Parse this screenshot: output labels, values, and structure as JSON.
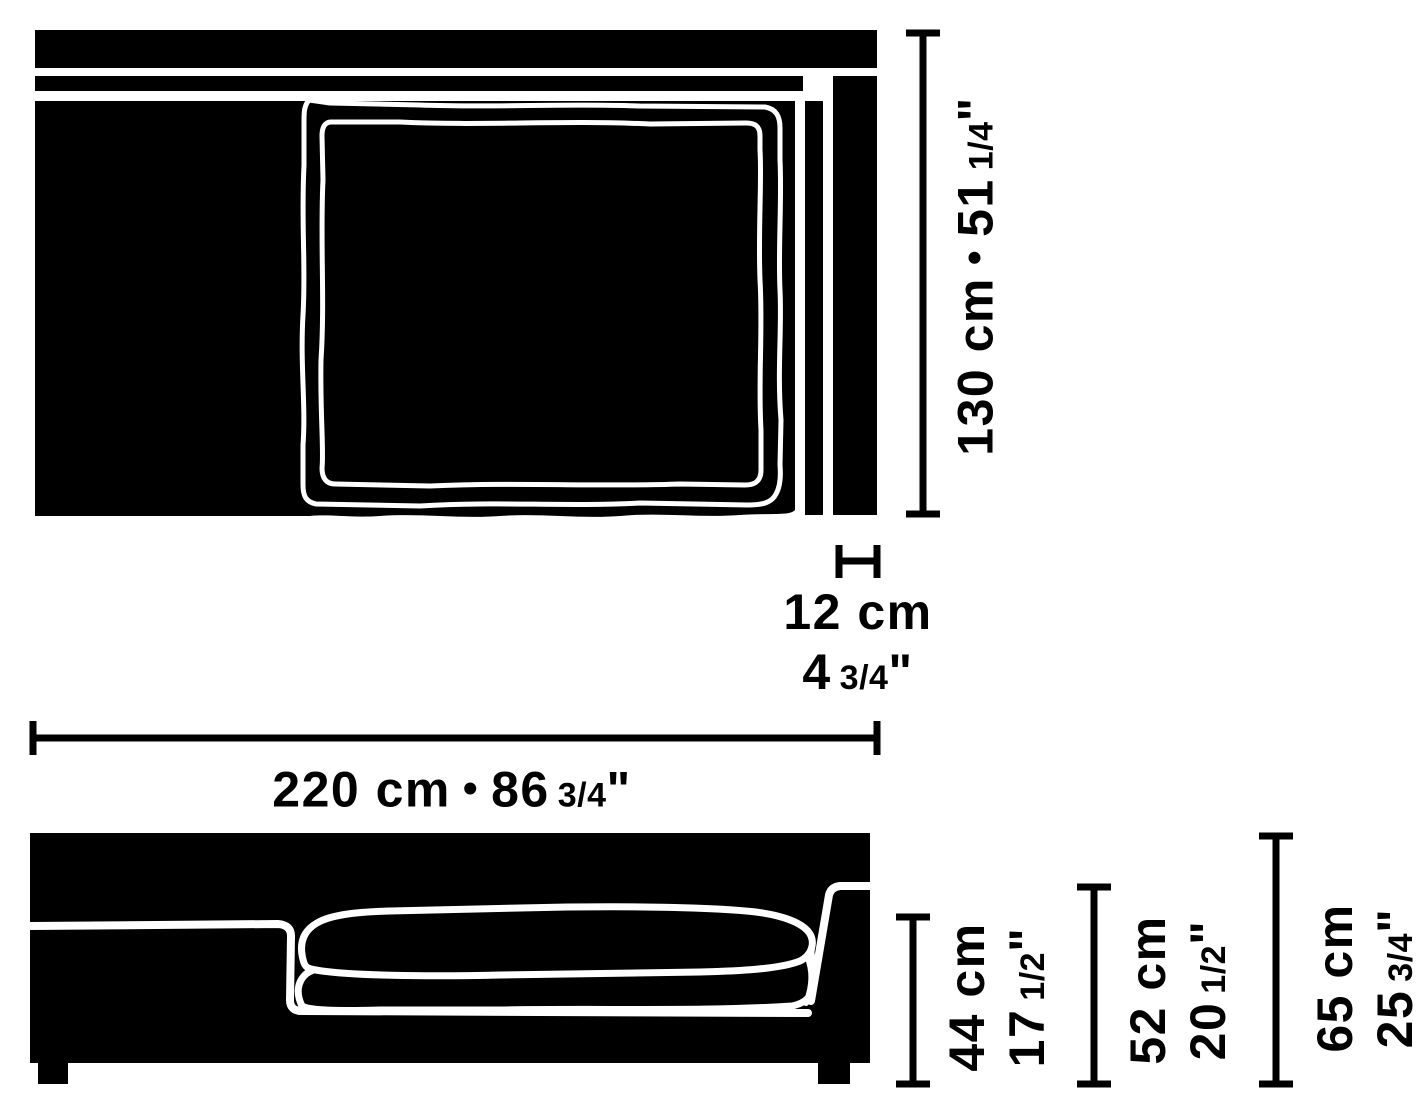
{
  "colors": {
    "ink": "#000000",
    "paper": "#ffffff",
    "sketch_line": "#ffffff"
  },
  "dimensions": {
    "depth": {
      "cm": "130 cm",
      "sep": "•",
      "inch_whole": "51",
      "inch_frac": "1/4",
      "inch_mark": "\""
    },
    "armrest_width": {
      "cm": "12 cm",
      "inch_whole": "4",
      "inch_frac": "3/4",
      "inch_mark": "\""
    },
    "width": {
      "cm": "220 cm",
      "sep": "•",
      "inch_whole": "86",
      "inch_frac": "3/4",
      "inch_mark": "\""
    },
    "seat_height": {
      "cm": "44 cm",
      "inch_whole": "17",
      "inch_frac": "1/2",
      "inch_mark": "\""
    },
    "back_height": {
      "cm": "52 cm",
      "inch_whole": "20",
      "inch_frac": "1/2",
      "inch_mark": "\""
    },
    "overall_height": {
      "cm": "65 cm",
      "inch_whole": "25",
      "inch_frac": "3/4",
      "inch_mark": "\""
    }
  }
}
